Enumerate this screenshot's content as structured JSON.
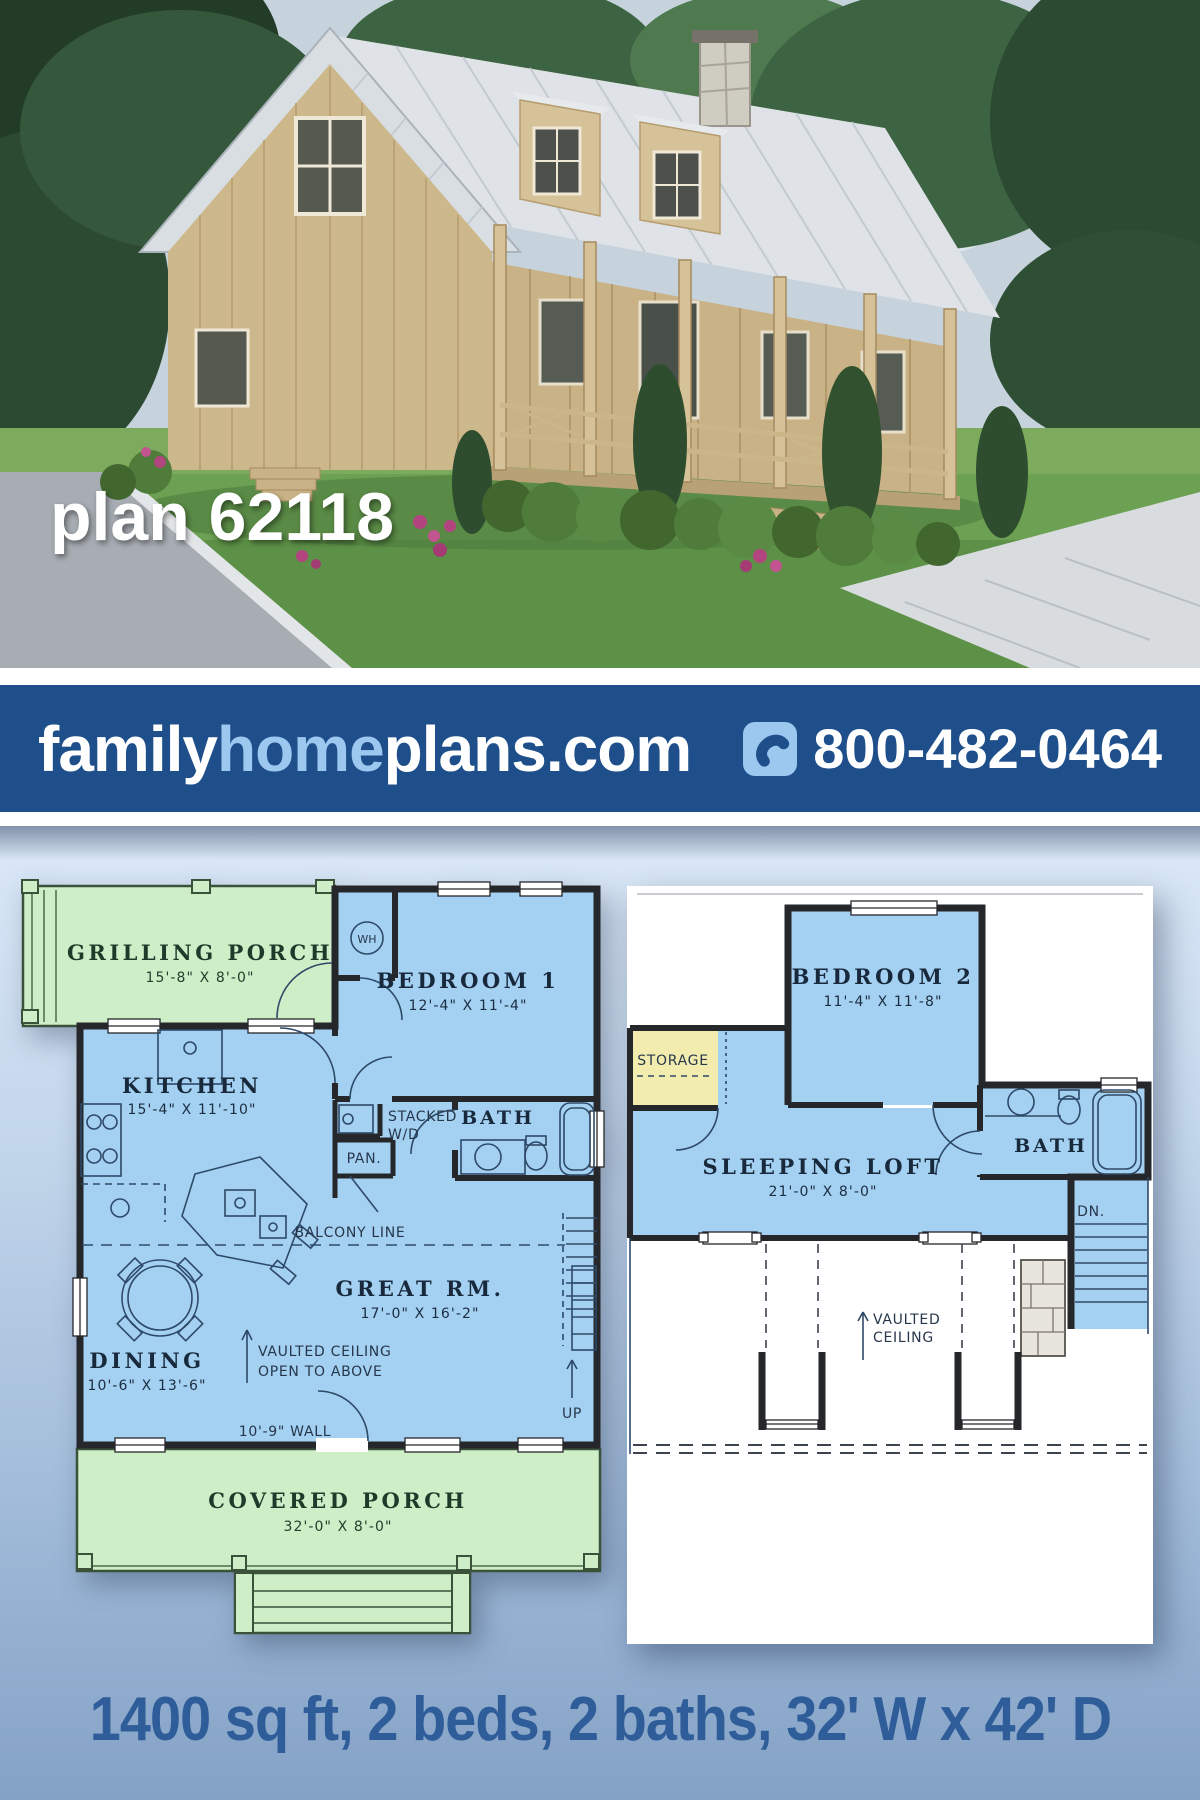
{
  "photo": {
    "plan_label": "plan 62118"
  },
  "banner": {
    "brand_family": "family",
    "brand_home": "home",
    "brand_plans": "plans.com",
    "phone": "800-482-0464",
    "bg_color": "#1f4f8b",
    "accent_color": "#9cc7ef"
  },
  "caption": {
    "text": "1400 sq ft, 2 beds, 2 baths, 32' W x 42' D",
    "color": "#2e5d99"
  },
  "colors": {
    "room_blue": "#a4d0f2",
    "porch_green": "#cdeec6",
    "storage_yellow": "#f2edae"
  },
  "first_floor": {
    "grilling_porch_name": "GRILLING PORCH",
    "grilling_porch_dims": "15'-8\" X 8'-0\"",
    "wh_label": "WH",
    "bedroom1_name": "BEDROOM 1",
    "bedroom1_dims": "12'-4\" X 11'-4\"",
    "kitchen_name": "KITCHEN",
    "kitchen_dims": "15'-4\" X 11'-10\"",
    "stacked_line1": "STACKED",
    "stacked_line2": "W/D",
    "pantry_label": "PAN.",
    "bath_label": "BATH",
    "balcony_label": "BALCONY LINE",
    "great_room_name": "GREAT RM.",
    "great_room_dims": "17'-0\" X 16'-2\"",
    "dining_name": "DINING",
    "dining_dims": "10'-6\" X 13'-6\"",
    "vaulted_line1": "VAULTED CEILING",
    "vaulted_line2": "OPEN TO ABOVE",
    "up_label": "UP",
    "wall_note": "10'-9\" WALL",
    "covered_porch_name": "COVERED PORCH",
    "covered_porch_dims": "32'-0\" X 8'-0\""
  },
  "second_floor": {
    "bedroom2_name": "BEDROOM 2",
    "bedroom2_dims": "11'-4\" X 11'-8\"",
    "storage_label": "STORAGE",
    "loft_name": "SLEEPING LOFT",
    "loft_dims": "21'-0\" X 8'-0\"",
    "bath_label": "BATH",
    "down_label": "DN.",
    "vaulted_line1": "VAULTED",
    "vaulted_line2": "CEILING"
  }
}
